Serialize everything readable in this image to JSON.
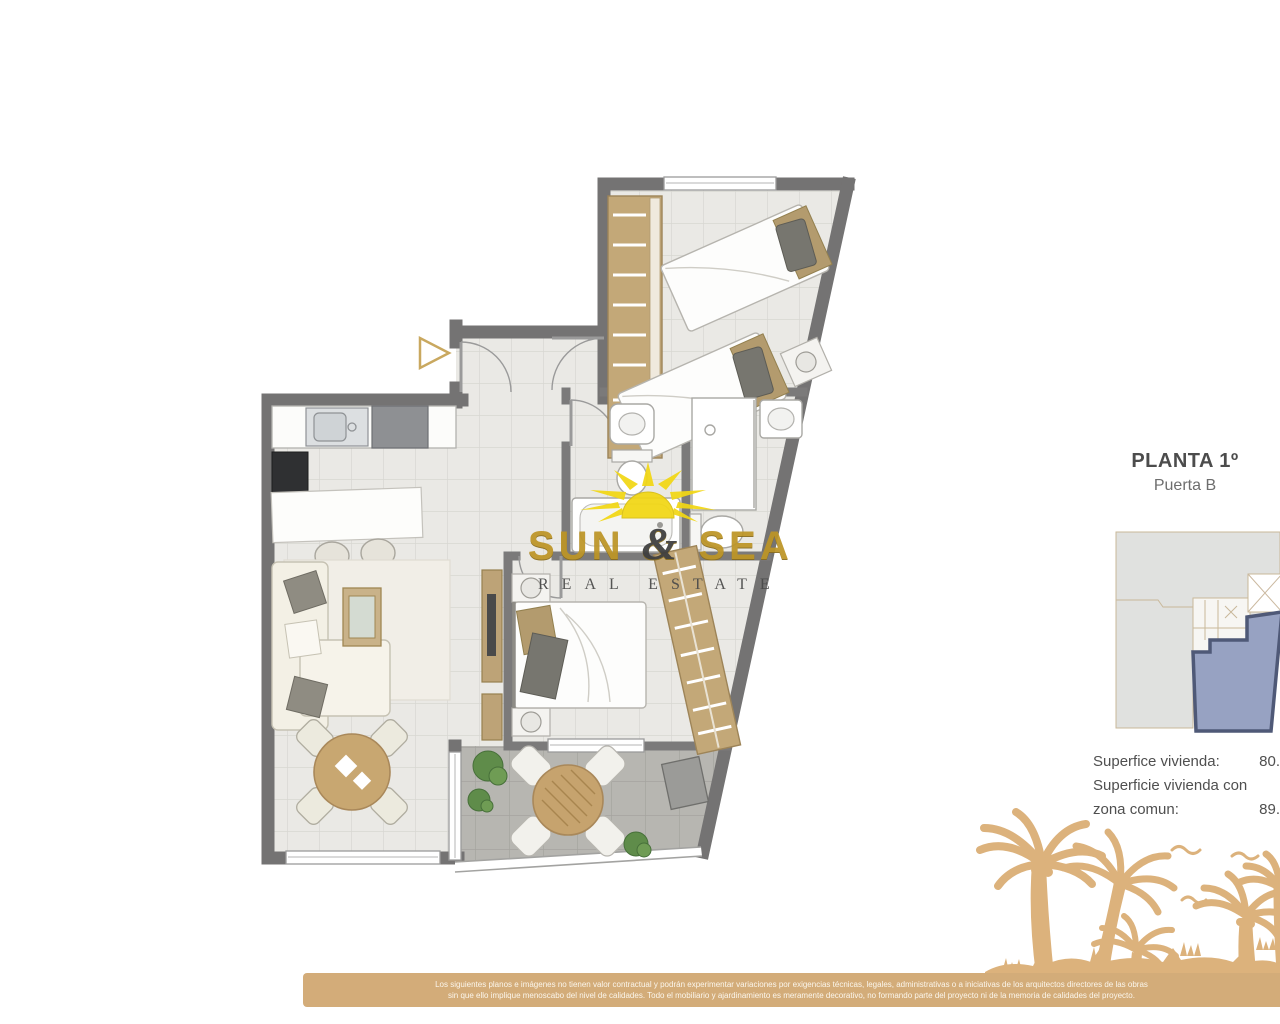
{
  "plan_label": {
    "title": "PLANTA 1º",
    "subtitle": "Puerta B"
  },
  "areas": {
    "line1_label": "Superfice vivienda:",
    "line1_value": "80.",
    "line2_label": "Superficie vivienda con",
    "line3_label": "zona comun:",
    "line3_value": "89."
  },
  "logo": {
    "word1": "SUN",
    "amp": "&",
    "word2": "SEA",
    "tagline": "REAL ESTATE"
  },
  "disclaimer": {
    "line1": "Los siguientes planos e imágenes no tienen valor contractual y podrán experimentar variaciones por exigencias técnicas, legales, administrativas o a iniciativas de los arquitectos directores de las obras",
    "line2": "sin que ello implique menoscabo del nivel de calidades. Todo el mobiliario y ajardinamiento es meramente decorativo, no formando parte del proyecto ni de la memoria de calidades del proyecto."
  },
  "colors": {
    "wall": "#747373",
    "floor_tile": "#eae9e5",
    "terrace_tile": "#b7b6b1",
    "wood": "#c3a878",
    "logo_gold": "#bd9526",
    "sun_yellow": "#f2d714",
    "keyplan_unit_fill": "#97a2c2",
    "keyplan_unit_border": "#4f5977",
    "palms_tan": "#dcb27c",
    "band_tan": "#d3ac79",
    "plant_green": "#5f8c4a"
  }
}
